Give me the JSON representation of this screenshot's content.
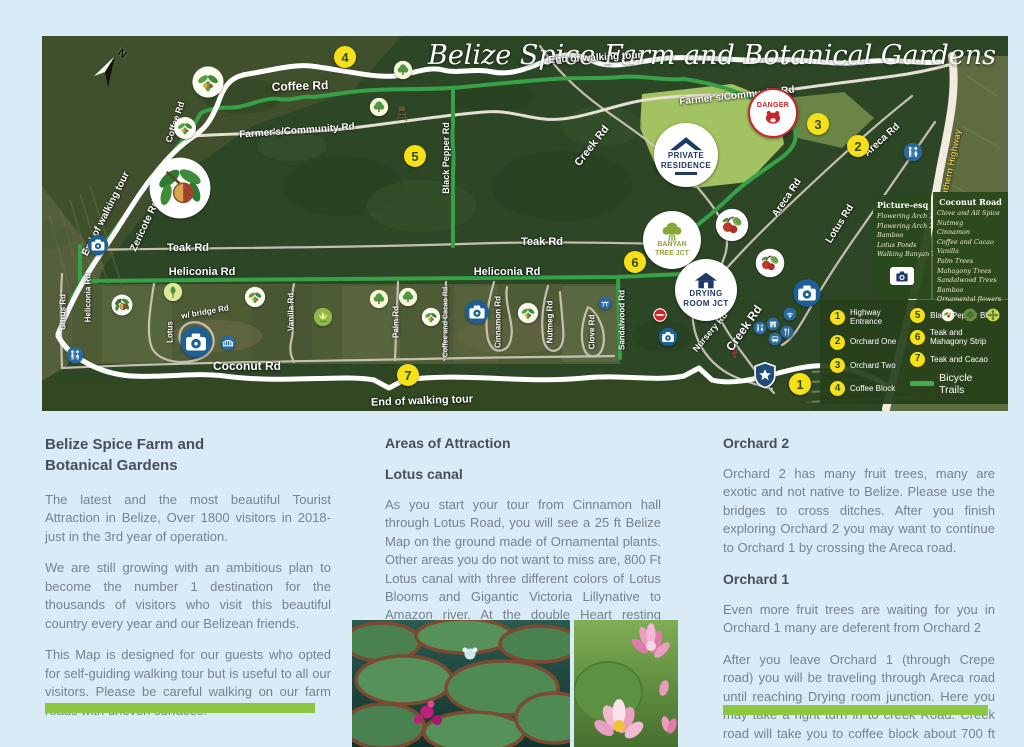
{
  "page": {
    "bg": "#d9ebf6"
  },
  "accent": {
    "green_bar": "#8dc63f",
    "marker_yellow": "#f7e017",
    "trail_green": "#3fae4d",
    "danger_red": "#c8252c"
  },
  "map": {
    "title": "Belize Spice Farm and Botanical Gardens",
    "compass_label": "N",
    "badges": {
      "danger": "DANGER",
      "private1": "PRIVATE",
      "private2": "RESIDENCE",
      "banyan1": "BANYAN",
      "banyan2": "TREE JCT",
      "drying1": "DRYING",
      "drying2": "ROOM JCT"
    },
    "road_labels": [
      {
        "t": "End of walking tour",
        "x": 553,
        "y": 22,
        "r": -3,
        "s": 10
      },
      {
        "t": "Coffee  Rd",
        "x": 258,
        "y": 50,
        "r": -2,
        "s": 12
      },
      {
        "t": "Coffee Rd",
        "x": 133,
        "y": 86,
        "r": -72,
        "s": 9
      },
      {
        "t": "Farmer's/Community Rd",
        "x": 255,
        "y": 95,
        "r": -4,
        "s": 10
      },
      {
        "t": "Farmer's/Community Rd",
        "x": 695,
        "y": 60,
        "r": -6,
        "s": 10
      },
      {
        "t": "End of walking tour",
        "x": 64,
        "y": 178,
        "r": -63,
        "s": 10
      },
      {
        "t": "Zericote  Rd",
        "x": 103,
        "y": 190,
        "r": -65,
        "s": 10
      },
      {
        "t": "Black Pepper  Rd",
        "x": 404,
        "y": 122,
        "r": -90,
        "s": 9
      },
      {
        "t": "Creek  Rd",
        "x": 550,
        "y": 110,
        "r": -52,
        "s": 11
      },
      {
        "t": "Areca  Rd",
        "x": 840,
        "y": 104,
        "r": -42,
        "s": 10
      },
      {
        "t": "Areca  Rd",
        "x": 745,
        "y": 162,
        "r": -56,
        "s": 10
      },
      {
        "t": "Crepe  Rd",
        "x": 654,
        "y": 132,
        "r": -48,
        "s": 10
      },
      {
        "t": "Lotus  Rd",
        "x": 798,
        "y": 188,
        "r": -58,
        "s": 10
      },
      {
        "t": "Teak Rd",
        "x": 146,
        "y": 212,
        "r": 0,
        "s": 11
      },
      {
        "t": "Teak Rd",
        "x": 500,
        "y": 206,
        "r": 0,
        "s": 11
      },
      {
        "t": "Heliconia  Rd",
        "x": 160,
        "y": 236,
        "r": 0,
        "s": 11
      },
      {
        "t": "Heliconia  Rd",
        "x": 465,
        "y": 236,
        "r": 0,
        "s": 11
      },
      {
        "t": "Heliconia  Rd",
        "x": 46,
        "y": 262,
        "r": -90,
        "s": 8
      },
      {
        "t": "Citrus Rd",
        "x": 21,
        "y": 276,
        "r": -90,
        "s": 8
      },
      {
        "t": "Lotus",
        "x": 128,
        "y": 296,
        "r": -90,
        "s": 8
      },
      {
        "t": "w/ bridge  Rd",
        "x": 163,
        "y": 276,
        "r": -10,
        "s": 8
      },
      {
        "t": "Vanilla Rd",
        "x": 249,
        "y": 276,
        "r": -90,
        "s": 8
      },
      {
        "t": "Palm Rd",
        "x": 354,
        "y": 286,
        "r": -90,
        "s": 8
      },
      {
        "t": "Coffee and Cacao  Rd",
        "x": 404,
        "y": 286,
        "r": -90,
        "s": 7
      },
      {
        "t": "Cinnamon Rd",
        "x": 456,
        "y": 286,
        "r": -90,
        "s": 8
      },
      {
        "t": "Nutmeg  Rd",
        "x": 508,
        "y": 286,
        "r": -90,
        "s": 8
      },
      {
        "t": "Clove  Rd",
        "x": 550,
        "y": 296,
        "r": -90,
        "s": 8
      },
      {
        "t": "Sandalwood Rd",
        "x": 580,
        "y": 284,
        "r": -90,
        "s": 8
      },
      {
        "t": "Nursery  Rd",
        "x": 668,
        "y": 296,
        "r": -50,
        "s": 9
      },
      {
        "t": "Creek  Rd",
        "x": 702,
        "y": 292,
        "r": -55,
        "s": 12
      },
      {
        "t": "Coconut  Rd",
        "x": 205,
        "y": 330,
        "r": 0,
        "s": 12
      },
      {
        "t": "End of walking tour",
        "x": 380,
        "y": 365,
        "r": -2,
        "s": 11
      },
      {
        "t": "Southern Highway",
        "x": 908,
        "y": 132,
        "r": -78,
        "s": 9,
        "c": "#e3c44c"
      }
    ],
    "markers": [
      {
        "n": "4",
        "x": 303,
        "y": 21
      },
      {
        "n": "3",
        "x": 776,
        "y": 88
      },
      {
        "n": "2",
        "x": 816,
        "y": 110
      },
      {
        "n": "5",
        "x": 373,
        "y": 120
      },
      {
        "n": "6",
        "x": 593,
        "y": 226
      },
      {
        "n": "7",
        "x": 366,
        "y": 339
      },
      {
        "n": "1",
        "x": 758,
        "y": 348
      }
    ],
    "icons": [
      {
        "type": "camera",
        "x": 56,
        "y": 209,
        "w": 22
      },
      {
        "type": "camera",
        "x": 154,
        "y": 306,
        "w": 34
      },
      {
        "type": "camera",
        "x": 435,
        "y": 276,
        "w": 26
      },
      {
        "type": "camera",
        "x": 626,
        "y": 301,
        "w": 20
      },
      {
        "type": "camera",
        "x": 765,
        "y": 257,
        "w": 30
      },
      {
        "type": "bridge",
        "x": 186,
        "y": 307,
        "w": 16
      },
      {
        "type": "restroom",
        "x": 33,
        "y": 319,
        "w": 18
      },
      {
        "type": "restroom",
        "x": 871,
        "y": 116,
        "w": 20
      },
      {
        "type": "restroom",
        "x": 718,
        "y": 292,
        "w": 14
      },
      {
        "type": "wifi",
        "x": 748,
        "y": 278,
        "w": 14
      },
      {
        "type": "shop",
        "x": 731,
        "y": 288,
        "w": 14
      },
      {
        "type": "food",
        "x": 745,
        "y": 296,
        "w": 14
      },
      {
        "type": "bus",
        "x": 733,
        "y": 303,
        "w": 14
      },
      {
        "type": "picnic",
        "x": 563,
        "y": 267,
        "w": 14
      },
      {
        "type": "star-shield",
        "x": 723,
        "y": 339,
        "w": 28
      },
      {
        "type": "no-entry",
        "x": 618,
        "y": 279,
        "w": 18
      },
      {
        "type": "hiker",
        "x": 693,
        "y": 318,
        "w": 12
      },
      {
        "type": "tree",
        "x": 361,
        "y": 34,
        "w": 20
      },
      {
        "type": "tree",
        "x": 337,
        "y": 71,
        "w": 20
      },
      {
        "type": "tree",
        "x": 337,
        "y": 263,
        "w": 20
      },
      {
        "type": "tree",
        "x": 366,
        "y": 261,
        "w": 20
      },
      {
        "type": "watchtower",
        "x": 360,
        "y": 77,
        "w": 18
      },
      {
        "type": "plant",
        "x": 166,
        "y": 46,
        "w": 34
      },
      {
        "type": "plant",
        "x": 143,
        "y": 92,
        "w": 24
      },
      {
        "type": "plant",
        "x": 213,
        "y": 261,
        "w": 22
      },
      {
        "type": "plant",
        "x": 389,
        "y": 281,
        "w": 20
      },
      {
        "type": "plant",
        "x": 486,
        "y": 277,
        "w": 22
      },
      {
        "type": "nutmeg",
        "x": 138,
        "y": 152,
        "w": 64
      },
      {
        "type": "nutmeg",
        "x": 80,
        "y": 269,
        "w": 22
      },
      {
        "type": "leaf",
        "x": 131,
        "y": 256,
        "w": 20
      },
      {
        "type": "lotus",
        "x": 281,
        "y": 281,
        "w": 20
      },
      {
        "type": "fruit",
        "x": 690,
        "y": 189,
        "w": 34
      },
      {
        "type": "fruit",
        "x": 728,
        "y": 227,
        "w": 30
      }
    ],
    "legend": {
      "items_left": [
        {
          "n": "1",
          "label": "Highway Entrance"
        },
        {
          "n": "2",
          "label": "Orchard One"
        },
        {
          "n": "3",
          "label": "Orchard Two"
        },
        {
          "n": "4",
          "label": "Coffee Block"
        }
      ],
      "items_right": [
        {
          "n": "5",
          "label": "Black Pepper Block"
        },
        {
          "n": "6",
          "label": "Teak and Mahagony Strip"
        },
        {
          "n": "7",
          "label": "Teak and Cacao"
        },
        {
          "n": "",
          "label": "Bicycle Trails"
        }
      ]
    },
    "picture_box": {
      "title": "Picture-esq",
      "items": [
        "Flowering Arch 1",
        "Flowering Arch 2",
        "Bamboo",
        "Lotus Ponds",
        "Walking Banyan Tree"
      ]
    },
    "coconut_box": {
      "title": "Coconut Road",
      "items": [
        "Clove and All Spice",
        "Nutmeg",
        "Cinnamon",
        "Coffee and Cacao",
        "Vanilla",
        "Palm Trees",
        "Mahagony Trees",
        "Sandalwood Trees",
        "Bamboo",
        "Ornamental flowers"
      ]
    }
  },
  "columns": {
    "left": {
      "h1": "Belize Spice Farm and",
      "h2": "Botanical Gardens",
      "p1": "The latest and the most beautiful Tourist Attraction in Belize, Over 1800 visitors in 2018- just in the 3rd year of operation.",
      "p2": "We are still growing with an ambitious plan to become the number 1 destination for the thousands of visitors who visit this beautiful country every year and our Belizean friends.",
      "p3": "This Map is designed for our guests who opted for self-guiding walking tour but is useful to all our visitors. Please be careful walking on our farm roads with uneven surfaces."
    },
    "middle": {
      "h": "Areas of Attraction",
      "sub": "Lotus canal",
      "p": "As you start your tour from Cinnamon hall through Lotus Road, you will see a 25 ft Belize Map on the ground made of Ornamental plants. Other areas you do not want to miss are, 800 Ft Lotus canal with three different colors of Lotus Blooms and Gigantic Victoria Lillynative to Amazon river. At the double Heart resting station, you may take a left turn to continue the walking tour to Orchard 2."
    },
    "right": {
      "h1": "Orchard 2",
      "p1": "Orchard 2 has many fruit trees, many are exotic and not native to Belize. Please use the bridges to cross ditches. After you finish exploring Orchard 2 you may want to continue to Orchard 1 by crossing the Areca road.",
      "h2": "Orchard 1",
      "p2": "Even more fruit trees are waiting for you in Orchard 1 many are deferent from Orchard 2",
      "p3": "After you leave Orchard 1 (through Crepe road) you will be traveling through Areca road until reaching Drying room junction. Here you may take a right turn in to creek Road. Creek road will take you to coffee block about 700 ft away."
    }
  }
}
